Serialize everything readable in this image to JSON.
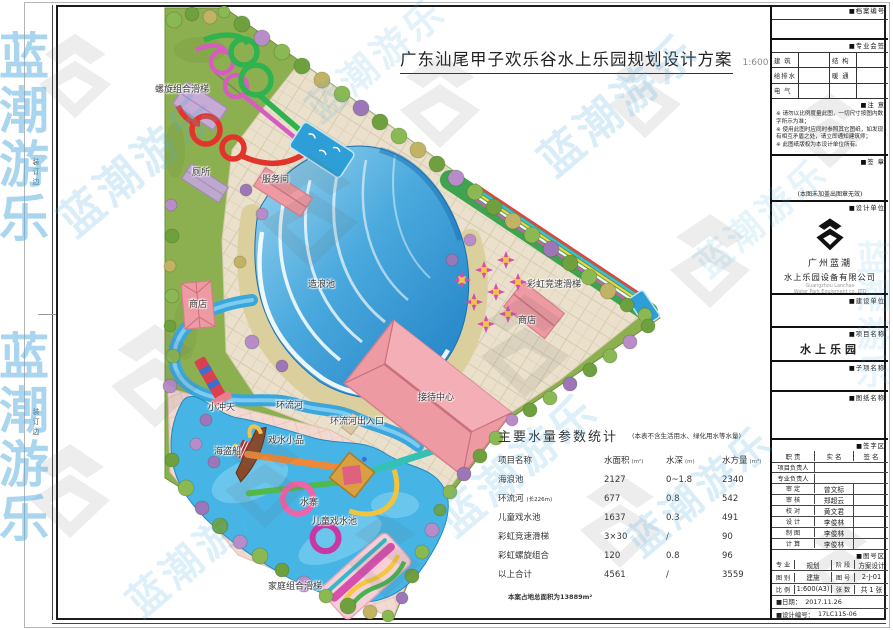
{
  "title": {
    "text": "广东汕尾甲子欢乐谷水上乐园规划设计方案",
    "scale": "1:600"
  },
  "binding_edge_label": "装订边",
  "watermark": {
    "text": "蓝潮游乐",
    "color": "#54aede"
  },
  "colors": {
    "water": "#3fa8dc",
    "lawn": "#8cb050",
    "paving": "#eae0cb",
    "building_pink": "#ee9aa3",
    "sand": "#dbcf9e",
    "accent_red": "#e3342c",
    "accent_green": "#2eb34e",
    "accent_magenta": "#d65cc0"
  },
  "plan": {
    "labels": [
      {
        "id": "spiral-slide",
        "text": "螺旋组合滑梯"
      },
      {
        "id": "toilet",
        "text": "厕所"
      },
      {
        "id": "service-room",
        "text": "服务间"
      },
      {
        "id": "shop-left",
        "text": "商店"
      },
      {
        "id": "wave-pool",
        "text": "造浪池"
      },
      {
        "id": "rainbow-racing-slide",
        "text": "彩虹竞速滑梯"
      },
      {
        "id": "shop-right",
        "text": "商店"
      },
      {
        "id": "reception-center",
        "text": "接待中心"
      },
      {
        "id": "lazy-river",
        "text": "环流河"
      },
      {
        "id": "lazy-river-entrance",
        "text": "环流河出入口"
      },
      {
        "id": "mini-tower",
        "text": "小冲天"
      },
      {
        "id": "water-play-features",
        "text": "戏水小品"
      },
      {
        "id": "pirate-ship",
        "text": "海盗船"
      },
      {
        "id": "water-fort",
        "text": "水寨"
      },
      {
        "id": "kids-pool",
        "text": "儿童戏水池"
      },
      {
        "id": "family-slide",
        "text": "家庭组合滑梯"
      }
    ]
  },
  "stats": {
    "title": "主要水量参数统计",
    "note": "(本表不含生活用水、绿化用水等水量)",
    "header": {
      "name": "项目名称",
      "area": "水面积",
      "area_u": "(m²)",
      "depth": "水深",
      "depth_u": "(m)",
      "vol": "水方量",
      "vol_u": "(m³)"
    },
    "rows": [
      {
        "name": "海浪池",
        "sub": "",
        "area": "2127",
        "depth": "0~1.8",
        "vol": "2340"
      },
      {
        "name": "环流河",
        "sub": "(长226m)",
        "area": "677",
        "depth": "0.8",
        "vol": "542"
      },
      {
        "name": "儿童戏水池",
        "sub": "",
        "area": "1637",
        "depth": "0.3",
        "vol": "491"
      },
      {
        "name": "彩虹竞速滑梯",
        "sub": "",
        "area": "3×30",
        "depth": "/",
        "vol": "90"
      },
      {
        "name": "彩虹螺旋组合",
        "sub": "",
        "area": "120",
        "depth": "0.8",
        "vol": "96"
      },
      {
        "name": "以上合计",
        "sub": "",
        "area": "4561",
        "depth": "/",
        "vol": "3559"
      }
    ],
    "footer": "本案占地总面积为13889m²"
  },
  "titleblock": {
    "archive_label": "■档案编号",
    "sign_label": "■专业会签",
    "disciplines": [
      [
        "建 筑",
        "",
        "结 构",
        ""
      ],
      [
        "给排水",
        "",
        "暖 通",
        ""
      ],
      [
        "电 气",
        "",
        "",
        ""
      ]
    ],
    "notice_label": "■注  意",
    "notes": [
      "※ 请勿以比例度量此图，一切尺寸按图内数字所示为准；",
      "※ 使用此图时应同时参照其它图纸，如发现有相互矛盾之处，请立即通知建筑师；",
      "※ 此图纸版权为本设计单位所有。"
    ],
    "seal_label": "■签  章",
    "seal_note": "(本图未加盖出图章无效)",
    "design_unit_label": "■设计单位",
    "company_cn1": "广州蓝潮",
    "company_cn2": "水上乐园设备有限公司",
    "company_en1": "Guangzhou Lanchao",
    "company_en2": "Water Park Equipment co.,LTD",
    "client_label": "■建设单位",
    "project_label": "■项目名称",
    "project_name": "水上乐园",
    "subproject_label": "■子项名称",
    "drawing_label": "■图纸名称",
    "signature_area_label": "■签字区",
    "sig_header": [
      "职 责",
      "实 名",
      "签 名"
    ],
    "signatures": [
      {
        "role": "项目负责人",
        "name": ""
      },
      {
        "role": "专业负责人",
        "name": ""
      },
      {
        "role": "审 定",
        "name": "曾文标"
      },
      {
        "role": "审 核",
        "name": "郑超云"
      },
      {
        "role": "校 对",
        "name": "黄文君"
      },
      {
        "role": "设 计",
        "name": "李俊林"
      },
      {
        "role": "制 图",
        "name": "李俊林"
      },
      {
        "role": "计 算",
        "name": "李俊林"
      }
    ],
    "number_area_label": "■图号区",
    "meta_rows": [
      [
        "专 业",
        "规划",
        "阶 段",
        "方案设计"
      ],
      [
        "图 别",
        "建施",
        "图 号",
        "2-J-01"
      ],
      [
        "比 例",
        "1:600(A3)",
        "张 数",
        "共 1 张"
      ]
    ],
    "date_row": {
      "label": "■日期：",
      "value": "2017.11.26"
    },
    "design_no_row": {
      "label": "■设计编号：",
      "value": "17LC115-06"
    }
  }
}
